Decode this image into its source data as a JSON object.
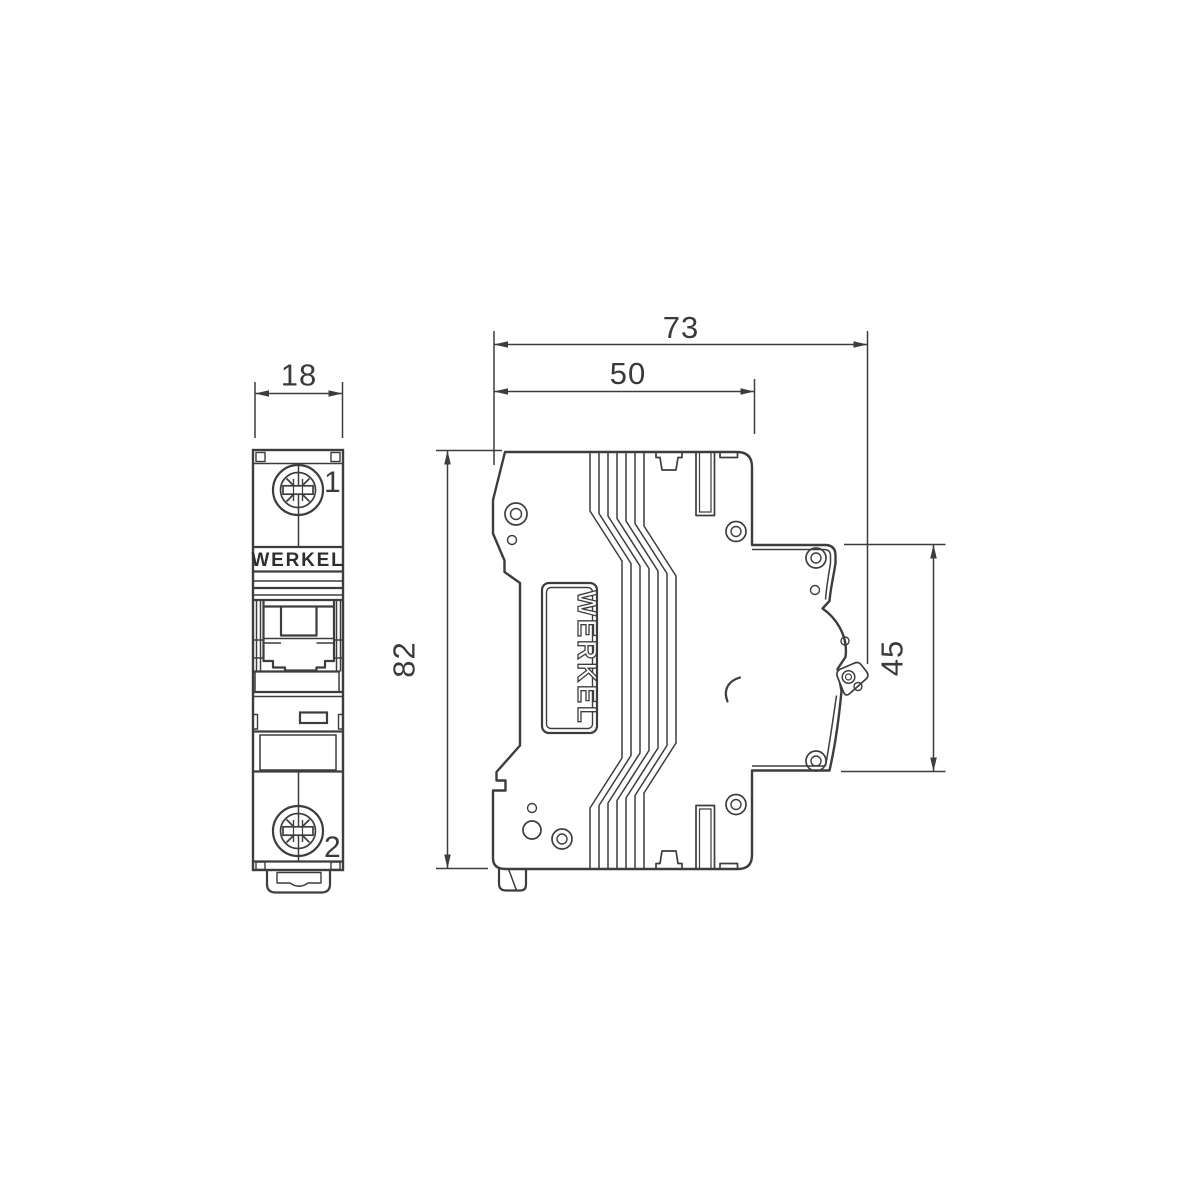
{
  "drawing": {
    "background": "#ffffff",
    "line_color": "#3d3d3d",
    "text_color": "#3a3a3a",
    "brand": "WERKEL",
    "front_view": {
      "brand_label": "WERKEL",
      "terminal_top": "1",
      "terminal_bottom": "2",
      "width_dim": "18"
    },
    "side_view": {
      "brand_label": "WERKEL",
      "overall_depth_dim": "73",
      "body_depth_dim": "50",
      "height_dim": "82",
      "din_section_dim": "45"
    }
  }
}
